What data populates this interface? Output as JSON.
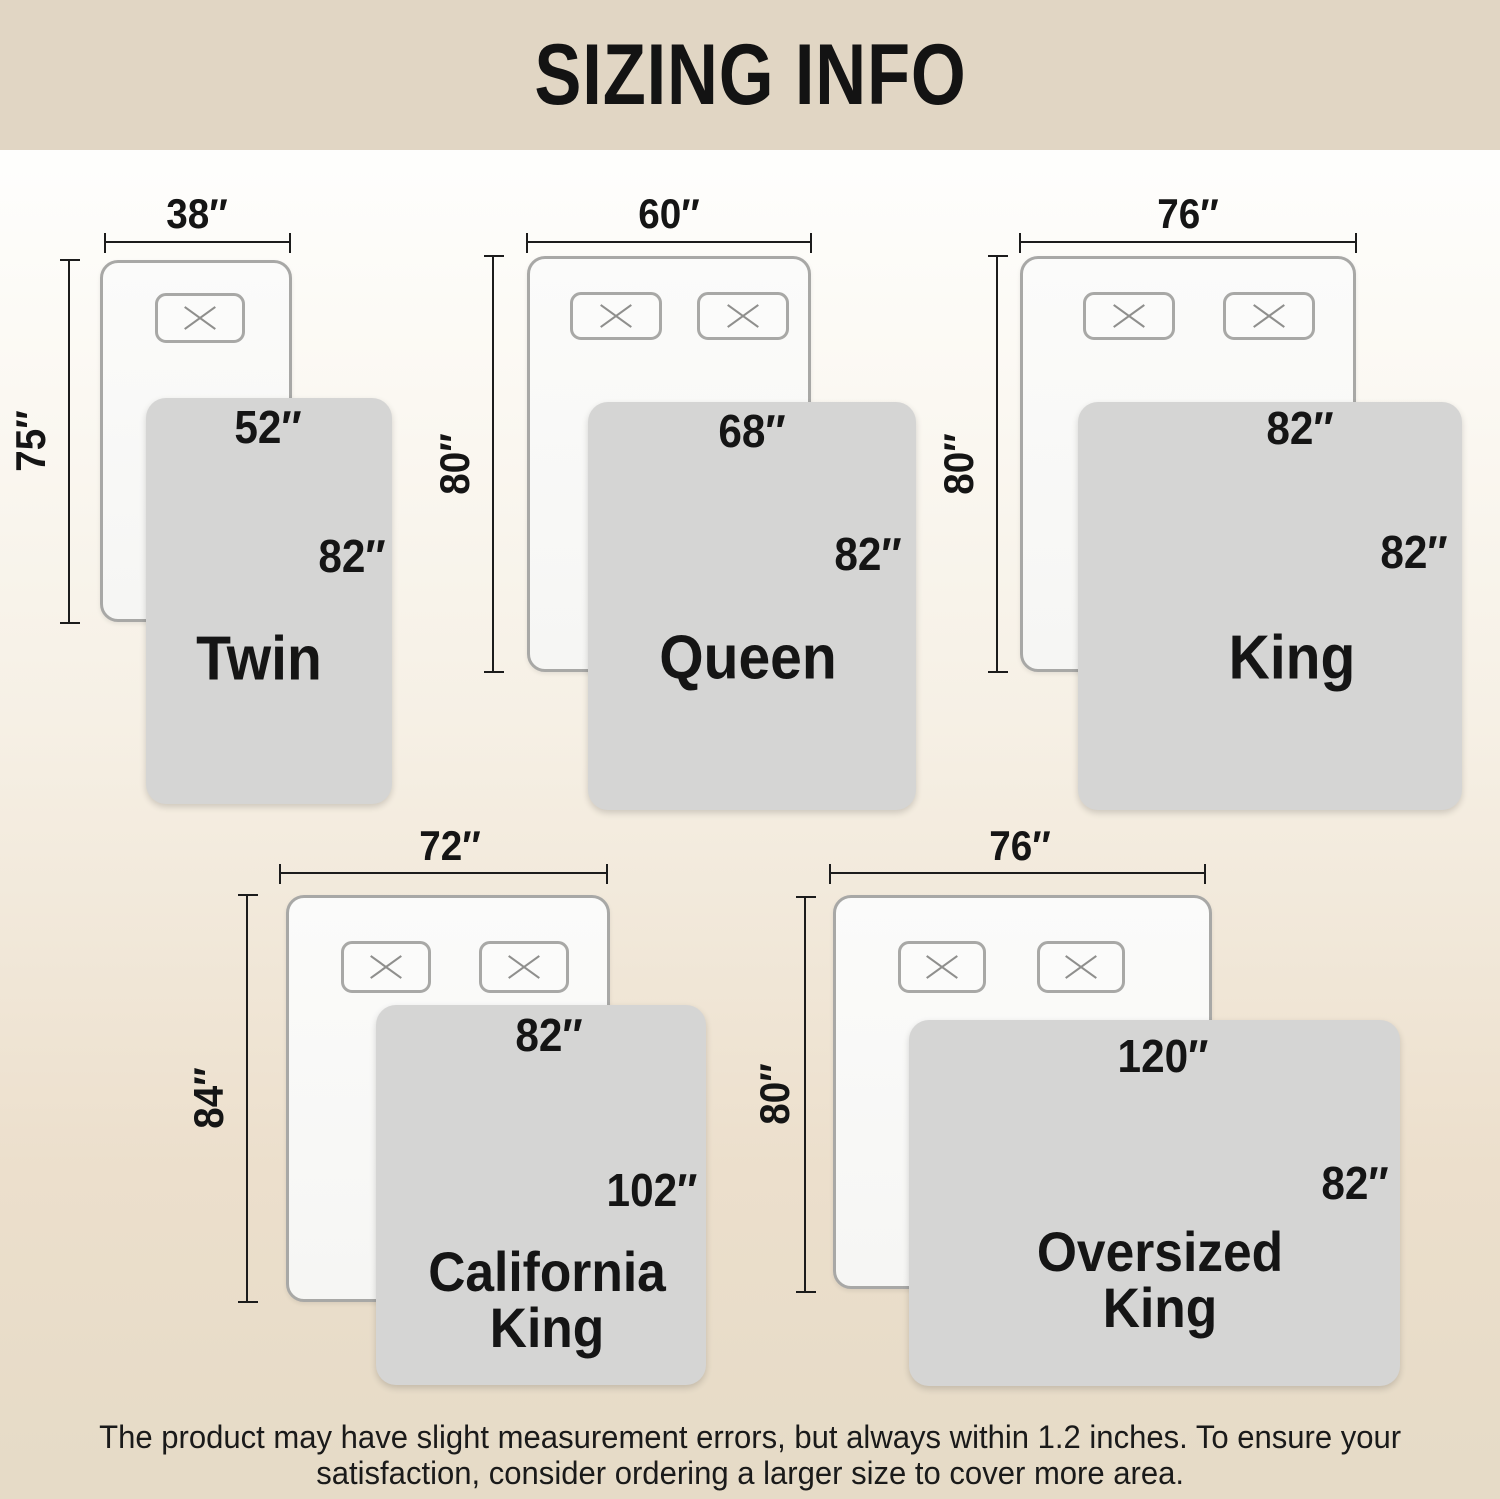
{
  "header": {
    "title": "SIZING INFO"
  },
  "sizes": [
    {
      "name": "Twin",
      "width_label": "38″",
      "height_label": "75″",
      "blanket_width_label": "52″",
      "blanket_length_label": "82″"
    },
    {
      "name": "Queen",
      "width_label": "60″",
      "height_label": "80″",
      "blanket_width_label": "68″",
      "blanket_length_label": "82″"
    },
    {
      "name": "King",
      "width_label": "76″",
      "height_label": "80″",
      "blanket_width_label": "82″",
      "blanket_length_label": "82″"
    },
    {
      "name_line1": "California",
      "name_line2": "King",
      "width_label": "72″",
      "height_label": "84″",
      "blanket_width_label": "82″",
      "blanket_length_label": "102″"
    },
    {
      "name_line1": "Oversized",
      "name_line2": "King",
      "width_label": "76″",
      "height_label": "80″",
      "blanket_width_label": "120″",
      "blanket_length_label": "82″"
    }
  ],
  "footer": {
    "line1": "The product may have slight measurement errors, but always within 1.2 inches. To ensure your",
    "line2": "satisfaction, consider ordering a larger size to cover more area."
  },
  "colors": {
    "header-bg": "#e1d6c4",
    "blanket": "#d5d5d4",
    "bed-fill": "#f8f8f7",
    "bed-border": "#a8a8a6",
    "dim-line": "#1c1c1c",
    "bg-top": "#fefefd",
    "bg-bottom": "#e6dbc8"
  }
}
